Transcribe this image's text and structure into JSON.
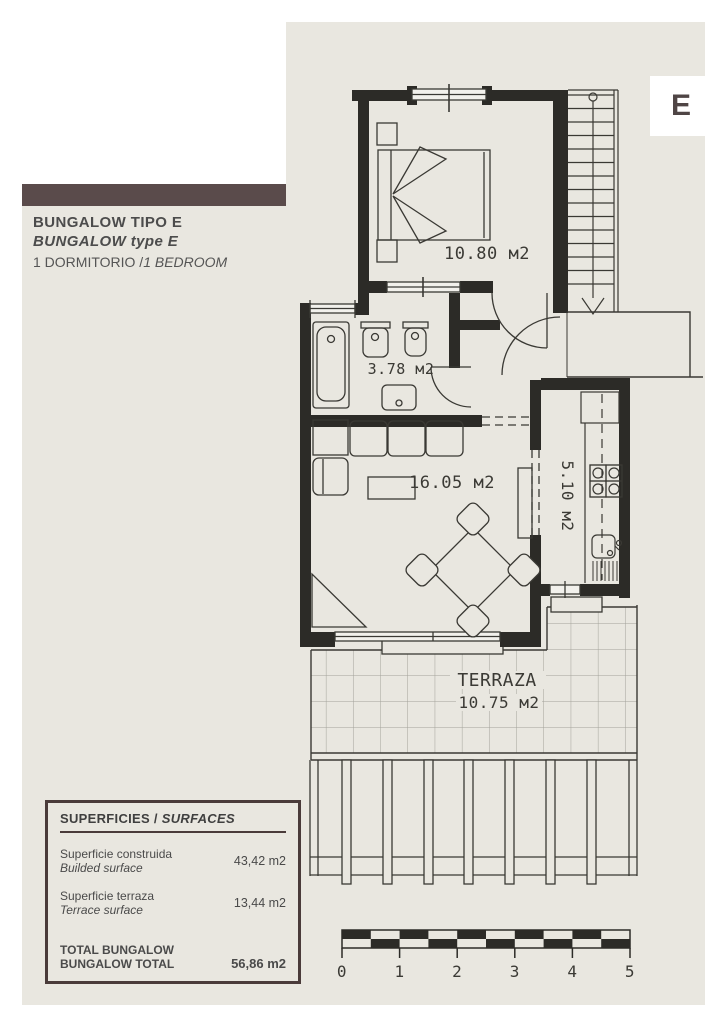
{
  "sheet": {
    "unit_letter": "E"
  },
  "title_block": {
    "line1": "BUNGALOW TIPO E",
    "line2": "BUNGALOW type E",
    "line3_regular": "1 DORMITORIO /",
    "line3_italic": "1 BEDROOM"
  },
  "rooms": {
    "bedroom": {
      "area": "10.80 м2"
    },
    "bathroom": {
      "area": "3.78 м2"
    },
    "living_room": {
      "area": "16.05 м2"
    },
    "kitchen": {
      "area": "5.10 м2"
    },
    "terrace": {
      "name": "TERRAZA",
      "area": "10.75 м2"
    }
  },
  "surfaces_table": {
    "title_es": "SUPERFICIES / ",
    "title_en": "SURFACES",
    "rows": [
      {
        "label_es": "Superficie construida",
        "label_en": "Builded surface",
        "value": "43,42 m2"
      },
      {
        "label_es": "Superficie terraza",
        "label_en": "Terrace surface",
        "value": "13,44 m2"
      }
    ],
    "total": {
      "label_es": "TOTAL BUNGALOW",
      "label_en": "BUNGALOW TOTAL",
      "value": "56,86 m2"
    }
  },
  "scale_bar": {
    "labels": [
      "0",
      "1",
      "2",
      "3",
      "4",
      "5"
    ]
  },
  "colors": {
    "background": "#ffffff",
    "panel": "#e9e7e0",
    "wall": "#2c2b27",
    "line": "#3a3934",
    "accent_brown": "#5a4b4b",
    "table_border": "#4a3b3a",
    "text": "#4c4c4c"
  }
}
